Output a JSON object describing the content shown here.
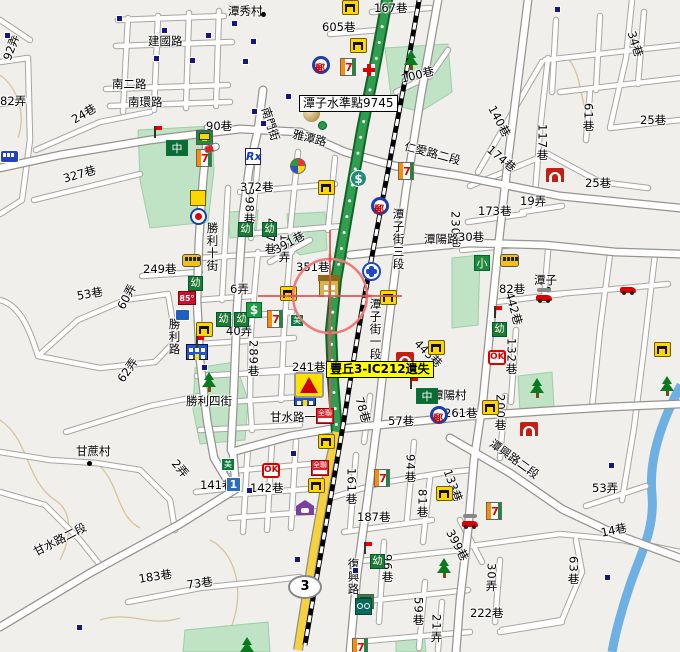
{
  "map": {
    "colors": {
      "background": "#f0efeb",
      "road_fill": "#ffffff",
      "road_casing": "#a8a5a0",
      "park": "#bfe3c4",
      "water": "#6fb0e2",
      "expressway_green": "#2f9e4f",
      "highway_yellow": "#f6d33c",
      "railway": "#000000",
      "crosshair": "#ef7a7a",
      "contour": "#d9c49a",
      "poi_square": "#14148c"
    },
    "highway_shield": {
      "number": "3",
      "x": 288,
      "y": 575
    },
    "callouts": [
      {
        "id": "benchmark",
        "text": "潭子水準點9745",
        "style": "white",
        "x": 299,
        "y": 95
      },
      {
        "id": "alert",
        "text": "豐丘3-IC212遺失",
        "style": "yellow",
        "x": 326,
        "y": 361
      }
    ],
    "places": [
      {
        "name": "潭秀村",
        "lx": 228,
        "ly": 3,
        "dx": 261,
        "dy": 12
      },
      {
        "name": "潭子",
        "lx": 534,
        "ly": 272,
        "dx": 546,
        "dy": 287
      },
      {
        "name": "甘蔗村",
        "lx": 76,
        "ly": 443,
        "dx": 87,
        "dy": 461
      }
    ],
    "street_labels": [
      {
        "t": "建國路",
        "x": 148,
        "y": 36
      },
      {
        "t": "南二路",
        "x": 112,
        "y": 79
      },
      {
        "t": "南環路",
        "x": 128,
        "y": 97
      },
      {
        "t": "92弄",
        "x": 2,
        "y": 58,
        "r": -70
      },
      {
        "t": "82弄",
        "x": 0,
        "y": 96
      },
      {
        "t": "24巷",
        "x": 70,
        "y": 116,
        "r": -30
      },
      {
        "t": "90巷",
        "x": 206,
        "y": 121
      },
      {
        "t": "327巷",
        "x": 62,
        "y": 174,
        "r": -16
      },
      {
        "t": "605巷",
        "x": 322,
        "y": 22
      },
      {
        "t": "167巷",
        "x": 374,
        "y": 3
      },
      {
        "t": "100巷",
        "x": 400,
        "y": 74,
        "r": -14
      },
      {
        "t": "34巷",
        "x": 636,
        "y": 30,
        "r": 72
      },
      {
        "t": "140巷",
        "x": 496,
        "y": 104,
        "r": 62
      },
      {
        "t": "174巷",
        "x": 492,
        "y": 144,
        "r": 40
      },
      {
        "t": "117巷",
        "x": 536,
        "y": 124,
        "v": 1
      },
      {
        "t": "25巷",
        "x": 640,
        "y": 115
      },
      {
        "t": "25巷",
        "x": 585,
        "y": 178
      },
      {
        "t": "19弄",
        "x": 520,
        "y": 196
      },
      {
        "t": "173巷",
        "x": 478,
        "y": 206
      },
      {
        "t": "61巷",
        "x": 582,
        "y": 103,
        "v": 1
      },
      {
        "t": "雅潭路",
        "x": 294,
        "y": 129,
        "r": 14
      },
      {
        "t": "南門街",
        "x": 270,
        "y": 106,
        "r": 72
      },
      {
        "t": "仁愛路二段",
        "x": 406,
        "y": 141,
        "r": 15
      },
      {
        "t": "372巷",
        "x": 240,
        "y": 182
      },
      {
        "t": "398巷",
        "x": 243,
        "y": 188,
        "v": 1
      },
      {
        "t": "457巷",
        "x": 264,
        "y": 218,
        "v": 1
      },
      {
        "t": "12弄",
        "x": 278,
        "y": 234,
        "v": 1
      },
      {
        "t": "勝利十街",
        "x": 206,
        "y": 222,
        "v": 1
      },
      {
        "t": "249巷",
        "x": 143,
        "y": 264
      },
      {
        "t": "53巷",
        "x": 76,
        "y": 291,
        "r": -10
      },
      {
        "t": "60弄",
        "x": 116,
        "y": 306,
        "r": -62
      },
      {
        "t": "62弄",
        "x": 116,
        "y": 378,
        "r": -55
      },
      {
        "t": "6弄",
        "x": 230,
        "y": 284
      },
      {
        "t": "40弄",
        "x": 226,
        "y": 326
      },
      {
        "t": "289巷",
        "x": 247,
        "y": 340,
        "v": 1
      },
      {
        "t": "勝利路",
        "x": 168,
        "y": 318,
        "v": 1
      },
      {
        "t": "391巷",
        "x": 272,
        "y": 246,
        "r": -28
      },
      {
        "t": "351巷",
        "x": 296,
        "y": 262
      },
      {
        "t": "241巷",
        "x": 292,
        "y": 362
      },
      {
        "t": "潭子街三段",
        "x": 392,
        "y": 208,
        "v": 1
      },
      {
        "t": "230巷",
        "x": 449,
        "y": 211,
        "v": 1
      },
      {
        "t": "潭陽路",
        "x": 424,
        "y": 234
      },
      {
        "t": "442巷",
        "x": 514,
        "y": 291,
        "r": 74
      },
      {
        "t": "443巷",
        "x": 420,
        "y": 338,
        "r": 45
      },
      {
        "t": "潭子街一段",
        "x": 369,
        "y": 298,
        "v": 1
      },
      {
        "t": "30巷",
        "x": 458,
        "y": 232
      },
      {
        "t": "82巷",
        "x": 499,
        "y": 284
      },
      {
        "t": "132巷",
        "x": 505,
        "y": 338,
        "v": 1
      },
      {
        "t": "200巷",
        "x": 494,
        "y": 394,
        "v": 1
      },
      {
        "t": "潭陽村",
        "x": 432,
        "y": 390
      },
      {
        "t": "261巷",
        "x": 444,
        "y": 408
      },
      {
        "t": "57巷",
        "x": 388,
        "y": 416
      },
      {
        "t": "78巷",
        "x": 364,
        "y": 396,
        "r": 74
      },
      {
        "t": "甘水路一段",
        "x": 270,
        "y": 412
      },
      {
        "t": "勝利四街",
        "x": 186,
        "y": 396
      },
      {
        "t": "甘水路二段",
        "x": 32,
        "y": 548,
        "r": -27
      },
      {
        "t": "183巷",
        "x": 138,
        "y": 574,
        "r": -9
      },
      {
        "t": "73巷",
        "x": 186,
        "y": 580,
        "r": -8
      },
      {
        "t": "141巷",
        "x": 200,
        "y": 480
      },
      {
        "t": "2弄",
        "x": 178,
        "y": 458,
        "r": 50
      },
      {
        "t": "142巷",
        "x": 250,
        "y": 483
      },
      {
        "t": "161巷",
        "x": 345,
        "y": 468,
        "v": 1
      },
      {
        "t": "187巷",
        "x": 357,
        "y": 512
      },
      {
        "t": "81巷",
        "x": 416,
        "y": 489,
        "v": 1
      },
      {
        "t": "94巷",
        "x": 404,
        "y": 454,
        "v": 1
      },
      {
        "t": "96巷",
        "x": 381,
        "y": 554,
        "v": 1
      },
      {
        "t": "59巷",
        "x": 412,
        "y": 597,
        "v": 1
      },
      {
        "t": "21弄",
        "x": 430,
        "y": 614,
        "v": 1
      },
      {
        "t": "復興路",
        "x": 347,
        "y": 558,
        "v": 1
      },
      {
        "t": "潭興路二段",
        "x": 494,
        "y": 438,
        "r": 36
      },
      {
        "t": "53弄",
        "x": 592,
        "y": 483
      },
      {
        "t": "14巷",
        "x": 600,
        "y": 528,
        "r": -12
      },
      {
        "t": "63巷",
        "x": 567,
        "y": 556,
        "v": 1
      },
      {
        "t": "30弄",
        "x": 485,
        "y": 563,
        "v": 1
      },
      {
        "t": "222巷",
        "x": 470,
        "y": 608
      },
      {
        "t": "399巷",
        "x": 454,
        "y": 528,
        "r": 62
      },
      {
        "t": "133巷",
        "x": 452,
        "y": 468,
        "r": 70
      }
    ],
    "pois": [
      {
        "t": "seven-eleven",
        "x": 196,
        "y": 149
      },
      {
        "t": "seven-eleven",
        "x": 340,
        "y": 58
      },
      {
        "t": "seven-eleven",
        "x": 398,
        "y": 162
      },
      {
        "t": "seven-eleven",
        "x": 267,
        "y": 310
      },
      {
        "t": "seven-eleven",
        "x": 374,
        "y": 469
      },
      {
        "t": "seven-eleven",
        "x": 486,
        "y": 502
      },
      {
        "t": "seven-eleven",
        "x": 352,
        "y": 638
      },
      {
        "t": "post-office",
        "x": 312,
        "y": 56
      },
      {
        "t": "post-office",
        "x": 371,
        "y": 197
      },
      {
        "t": "post-office",
        "x": 430,
        "y": 406
      },
      {
        "t": "bench",
        "x": 342,
        "y": 0
      },
      {
        "t": "bench",
        "x": 350,
        "y": 38
      },
      {
        "t": "bench",
        "x": 318,
        "y": 180
      },
      {
        "t": "bench",
        "x": 196,
        "y": 322
      },
      {
        "t": "bench",
        "x": 280,
        "y": 286
      },
      {
        "t": "bench",
        "x": 380,
        "y": 290
      },
      {
        "t": "bench",
        "x": 654,
        "y": 342
      },
      {
        "t": "bench",
        "x": 482,
        "y": 400
      },
      {
        "t": "bench",
        "x": 318,
        "y": 434
      },
      {
        "t": "bench",
        "x": 308,
        "y": 478
      },
      {
        "t": "bench",
        "x": 436,
        "y": 486
      },
      {
        "t": "bench",
        "x": 428,
        "y": 340
      },
      {
        "t": "temple-swastika",
        "x": 190,
        "y": 190
      },
      {
        "t": "temple-red",
        "x": 546,
        "y": 168
      },
      {
        "t": "temple-red",
        "x": 396,
        "y": 352
      },
      {
        "t": "temple-red",
        "x": 520,
        "y": 422
      },
      {
        "t": "school-mid",
        "x": 166,
        "y": 140,
        "g": "中"
      },
      {
        "t": "school-mid",
        "x": 416,
        "y": 388,
        "g": "中"
      },
      {
        "t": "school-small",
        "x": 474,
        "y": 255,
        "g": "小"
      },
      {
        "t": "kindergarten",
        "x": 238,
        "y": 222,
        "g": "幼"
      },
      {
        "t": "kindergarten",
        "x": 262,
        "y": 222,
        "g": "幼"
      },
      {
        "t": "kindergarten",
        "x": 188,
        "y": 276,
        "g": "幼"
      },
      {
        "t": "kindergarten",
        "x": 216,
        "y": 312,
        "g": "幼"
      },
      {
        "t": "kindergarten",
        "x": 234,
        "y": 312,
        "g": "幼"
      },
      {
        "t": "kindergarten",
        "x": 492,
        "y": 322,
        "g": "幼"
      },
      {
        "t": "kindergarten",
        "x": 370,
        "y": 554,
        "g": "幼"
      },
      {
        "t": "bank-green",
        "x": 246,
        "y": 302,
        "g": "$"
      },
      {
        "t": "bank-teal",
        "x": 350,
        "y": 170,
        "g": "$"
      },
      {
        "t": "shopping-cart",
        "x": 196,
        "y": 130
      },
      {
        "t": "shopping-cart",
        "x": 357,
        "y": 594
      },
      {
        "t": "ok-mart",
        "x": 488,
        "y": 350,
        "g": "OK"
      },
      {
        "t": "ok-mart",
        "x": 262,
        "y": 463,
        "g": "OK"
      },
      {
        "t": "px-mart",
        "x": 311,
        "y": 460,
        "g": "全聯"
      },
      {
        "t": "px-mart",
        "x": 316,
        "y": 408,
        "g": "全聯"
      },
      {
        "t": "first-bank",
        "x": 226,
        "y": 477,
        "g": "1"
      },
      {
        "t": "simple-mart",
        "x": 221,
        "y": 458,
        "g": "美"
      },
      {
        "t": "simple-mart",
        "x": 290,
        "y": 314,
        "g": "美"
      },
      {
        "t": "cafe-85c",
        "x": 178,
        "y": 291,
        "g": "85°"
      },
      {
        "t": "blue-store",
        "x": 175,
        "y": 309
      },
      {
        "t": "gas-station",
        "x": 190,
        "y": 208
      },
      {
        "t": "pharmacy-rx",
        "x": 245,
        "y": 148,
        "g": "Rx"
      },
      {
        "t": "capsule",
        "x": 204,
        "y": 144
      },
      {
        "t": "pinwheel",
        "x": 290,
        "y": 158
      },
      {
        "t": "gold-sphere",
        "x": 303,
        "y": 105
      },
      {
        "t": "green-ball",
        "x": 318,
        "y": 121
      },
      {
        "t": "tra-station",
        "x": 362,
        "y": 262
      },
      {
        "t": "rail-building",
        "x": 319,
        "y": 278
      },
      {
        "t": "govt-building",
        "x": 186,
        "y": 344
      },
      {
        "t": "govt-building",
        "x": 294,
        "y": 390
      },
      {
        "t": "warning-triangle",
        "x": 294,
        "y": 372
      },
      {
        "t": "purple-house",
        "x": 296,
        "y": 500
      },
      {
        "t": "bike-shop",
        "x": 355,
        "y": 598
      },
      {
        "t": "car-repair",
        "x": 536,
        "y": 288
      },
      {
        "t": "car-repair",
        "x": 462,
        "y": 514
      },
      {
        "t": "red-car",
        "x": 620,
        "y": 280
      },
      {
        "t": "bus-yellow",
        "x": 182,
        "y": 254
      },
      {
        "t": "bus-yellow",
        "x": 500,
        "y": 254
      },
      {
        "t": "bus-blue",
        "x": 0,
        "y": 150
      },
      {
        "t": "red-cross",
        "x": 363,
        "y": 64
      },
      {
        "t": "tree",
        "x": 404,
        "y": 50
      },
      {
        "t": "tree",
        "x": 202,
        "y": 372
      },
      {
        "t": "tree",
        "x": 530,
        "y": 378
      },
      {
        "t": "tree",
        "x": 660,
        "y": 376
      },
      {
        "t": "tree",
        "x": 437,
        "y": 558
      },
      {
        "t": "tree",
        "x": 240,
        "y": 637
      },
      {
        "t": "flagpole",
        "x": 154,
        "y": 126
      },
      {
        "t": "flagpole",
        "x": 494,
        "y": 306
      },
      {
        "t": "flagpole",
        "x": 364,
        "y": 542
      },
      {
        "t": "flagpole",
        "x": 410,
        "y": 377
      },
      {
        "t": "flagpole",
        "x": 196,
        "y": 336
      },
      {
        "t": "poi-square",
        "x": 4,
        "y": 32
      },
      {
        "t": "poi-square",
        "x": 116,
        "y": 15
      },
      {
        "t": "poi-square",
        "x": 161,
        "y": 27
      },
      {
        "t": "poi-square",
        "x": 205,
        "y": 32
      },
      {
        "t": "poi-square",
        "x": 153,
        "y": 55
      },
      {
        "t": "poi-square",
        "x": 189,
        "y": 57
      },
      {
        "t": "poi-square",
        "x": 242,
        "y": 58
      },
      {
        "t": "poi-square",
        "x": 231,
        "y": 20
      },
      {
        "t": "poi-square",
        "x": 250,
        "y": 38
      },
      {
        "t": "poi-square",
        "x": 285,
        "y": 93
      },
      {
        "t": "poi-square",
        "x": 251,
        "y": 108
      },
      {
        "t": "poi-square",
        "x": 260,
        "y": 120
      },
      {
        "t": "poi-square",
        "x": 308,
        "y": 95
      },
      {
        "t": "poi-square",
        "x": 554,
        "y": 6
      },
      {
        "t": "poi-square",
        "x": 76,
        "y": 624
      },
      {
        "t": "poi-square",
        "x": 294,
        "y": 556
      },
      {
        "t": "poi-square",
        "x": 608,
        "y": 462
      },
      {
        "t": "poi-square",
        "x": 604,
        "y": 574
      },
      {
        "t": "poi-square",
        "x": 352,
        "y": 567
      },
      {
        "t": "poi-square",
        "x": 201,
        "y": 364
      },
      {
        "t": "poi-square",
        "x": 246,
        "y": 487
      },
      {
        "t": "poi-square",
        "x": 290,
        "y": 450
      }
    ]
  }
}
